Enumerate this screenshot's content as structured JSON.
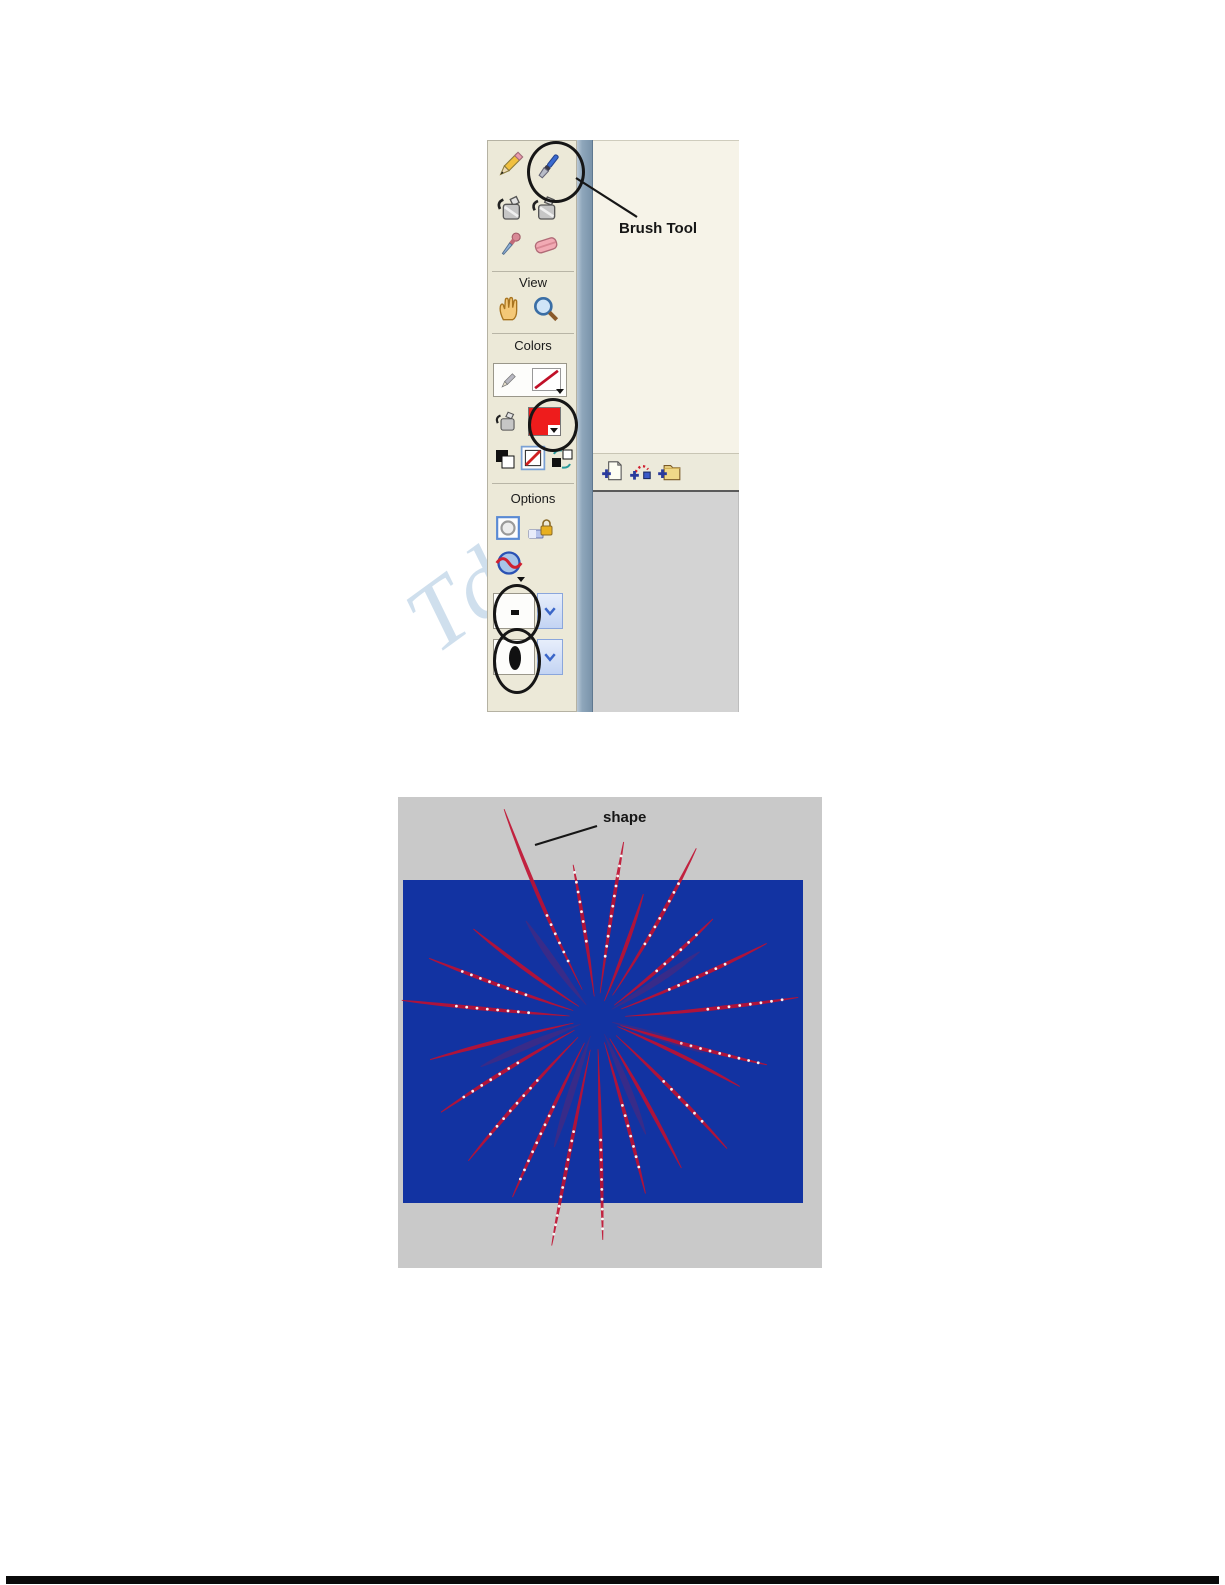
{
  "watermark": {
    "text": "Td"
  },
  "colors": {
    "toolbar_panel": "#ece9d8",
    "right_panel": "#f6f3e8",
    "timeline_gray": "#d3d3d3",
    "pasteboard_gray": "#c9c9c9",
    "stage_blue": "#1233a2",
    "firework_red": "#c01030",
    "spark_white": "#ffffff",
    "fill_swatch_red": "#ee1c1c",
    "annotation_black": "#161616"
  },
  "toolbar": {
    "annotation_label": "Brush Tool",
    "section_labels": {
      "view": "View",
      "colors": "Colors",
      "options": "Options"
    },
    "tools": [
      "pencil-tool",
      "brush-tool",
      "ink-bottle-tool",
      "paint-bucket-tool",
      "eyedropper-tool",
      "eraser-tool",
      "hand-tool",
      "zoom-tool"
    ],
    "circled_items": [
      "brush-tool",
      "fill-color-swatch",
      "brush-size-dropdown",
      "brush-shape-dropdown"
    ]
  },
  "timeline": {
    "icons": [
      "insert-layer-icon",
      "add-motion-guide-icon",
      "insert-layer-folder-icon"
    ]
  },
  "canvas": {
    "annotation_label": "shape",
    "stage_rect": {
      "x": 5,
      "y": 83,
      "w": 400,
      "h": 323
    },
    "fireworks": {
      "center": [
        199,
        221
      ],
      "rays": [
        {
          "a": 118,
          "r": 228,
          "b": 16,
          "d": 1,
          "ds": 0.28,
          "de": 0.5
        },
        {
          "a": 97,
          "r": 155,
          "b": -5,
          "d": 1,
          "ds": 0.5,
          "de": 0.95
        },
        {
          "a": 83,
          "r": 178,
          "b": 5,
          "d": 1,
          "ds": 0.35,
          "de": 0.92
        },
        {
          "a": 66,
          "r": 132,
          "b": -8,
          "d": 0
        },
        {
          "a": 55,
          "r": 196,
          "b": -16,
          "d": 1,
          "ds": 0.45,
          "de": 0.8
        },
        {
          "a": 36,
          "r": 152,
          "b": -12,
          "d": 1,
          "ds": 0.5,
          "de": 0.85
        },
        {
          "a": 20,
          "r": 185,
          "b": -12,
          "d": 1,
          "ds": 0.42,
          "de": 0.75
        },
        {
          "a": 3,
          "r": 202,
          "b": -10,
          "d": 1,
          "ds": 0.55,
          "de": 0.92
        },
        {
          "a": -18,
          "r": 176,
          "b": -8,
          "d": 1,
          "ds": 0.5,
          "de": 0.95
        },
        {
          "a": 148,
          "r": 152,
          "b": 10,
          "d": 0
        },
        {
          "a": 163,
          "r": 178,
          "b": 8,
          "d": 1,
          "ds": 0.42,
          "de": 0.8
        },
        {
          "a": 176,
          "r": 196,
          "b": 4,
          "d": 1,
          "ds": 0.35,
          "de": 0.72
        },
        {
          "a": 192,
          "r": 172,
          "b": -6,
          "d": 0
        },
        {
          "a": 208,
          "r": 182,
          "b": -10,
          "d": 1,
          "ds": 0.5,
          "de": 0.85
        },
        {
          "a": 225,
          "r": 192,
          "b": -10,
          "d": 1,
          "ds": 0.45,
          "de": 0.82
        },
        {
          "a": 243,
          "r": 198,
          "b": -6,
          "d": 1,
          "ds": 0.5,
          "de": 0.9
        },
        {
          "a": 258,
          "r": 232,
          "b": -3,
          "d": 1,
          "ds": 0.5,
          "de": 0.95
        },
        {
          "a": 272,
          "r": 222,
          "b": 2,
          "d": 1,
          "ds": 0.55,
          "de": 0.95
        },
        {
          "a": 287,
          "r": 182,
          "b": 5,
          "d": 1,
          "ds": 0.5,
          "de": 0.85
        },
        {
          "a": 302,
          "r": 172,
          "b": 8,
          "d": 0
        },
        {
          "a": 318,
          "r": 184,
          "b": 10,
          "d": 1,
          "ds": 0.5,
          "de": 0.8
        },
        {
          "a": 338,
          "r": 158,
          "b": 10,
          "d": 0
        },
        {
          "a": 30,
          "r": 122,
          "b": -6,
          "o": 0.22,
          "w": 3,
          "d": 0
        },
        {
          "a": 130,
          "r": 120,
          "b": 8,
          "o": 0.22,
          "w": 3,
          "d": 0
        },
        {
          "a": 200,
          "r": 126,
          "b": -6,
          "o": 0.22,
          "w": 3,
          "d": 0
        },
        {
          "a": 250,
          "r": 136,
          "b": -4,
          "o": 0.22,
          "w": 3,
          "d": 0
        },
        {
          "a": 295,
          "r": 126,
          "b": 5,
          "o": 0.22,
          "w": 3,
          "d": 0
        },
        {
          "a": 345,
          "r": 112,
          "b": 6,
          "o": 0.22,
          "w": 3,
          "d": 0
        }
      ]
    }
  }
}
